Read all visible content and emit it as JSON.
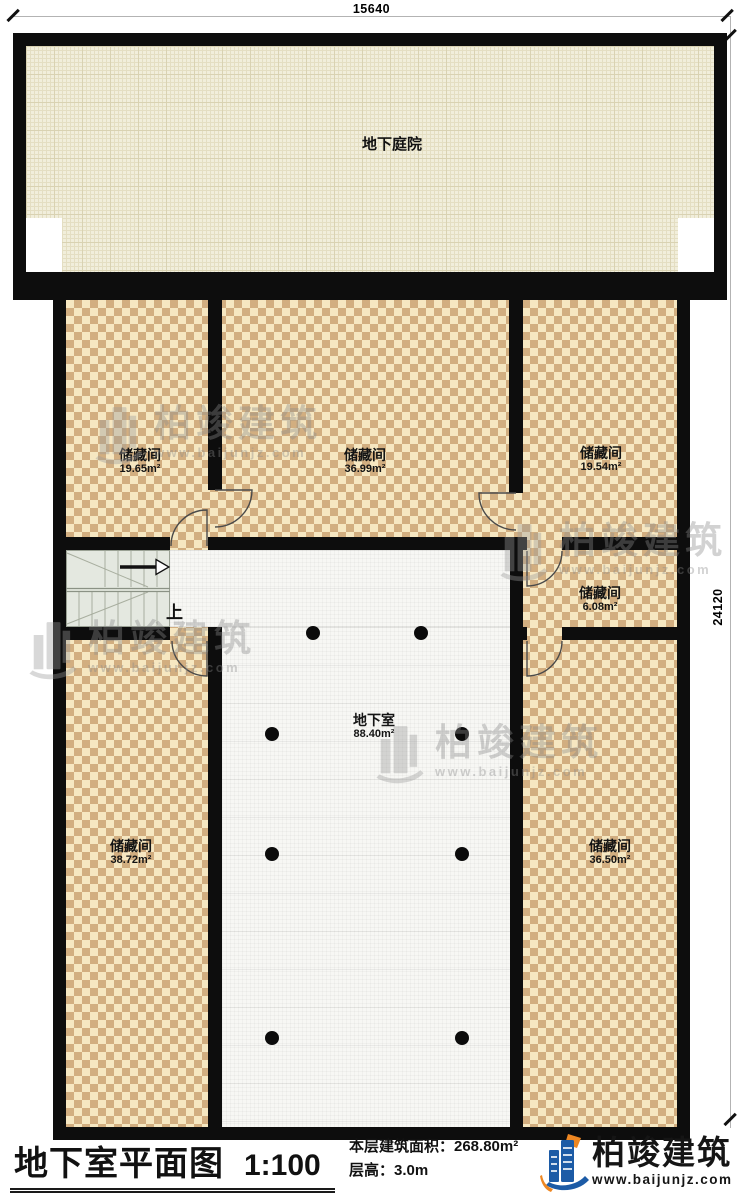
{
  "dimensions": {
    "top": "15640",
    "right": "24120"
  },
  "plan": {
    "courtyard": {
      "name": "地下庭院"
    },
    "storage_rooms": [
      {
        "name": "储藏间",
        "area": "19.65m²"
      },
      {
        "name": "储藏间",
        "area": "36.99m²"
      },
      {
        "name": "储藏间",
        "area": "19.54m²"
      },
      {
        "name": "储藏间",
        "area": "6.08m²"
      },
      {
        "name": "储藏间",
        "area": "38.72m²"
      },
      {
        "name": "储藏间",
        "area": "36.50m²"
      }
    ],
    "basement": {
      "name": "地下室",
      "area": "88.40m²"
    },
    "stairs": {
      "up_label": "上"
    }
  },
  "footer": {
    "title": "地下室平面图",
    "scale": "1:100",
    "area_line": "本层建筑面积：268.80m²",
    "height_line": "层高：3.0m"
  },
  "brand": {
    "name": "柏竣建筑",
    "website": "www.baijunjz.com"
  },
  "colors": {
    "wall": "#0d0d0d",
    "checker_light": "#f6e7c1",
    "checker_dark": "#d2ae80",
    "courtyard_floor": "#f1eedb",
    "basement_floor": "#f7f7f4",
    "stair_fill": "#e4e8e0",
    "brand_blue": "#1c5ba6",
    "brand_orange": "#ee8722",
    "watermark_gray": "#9a9a9a"
  }
}
